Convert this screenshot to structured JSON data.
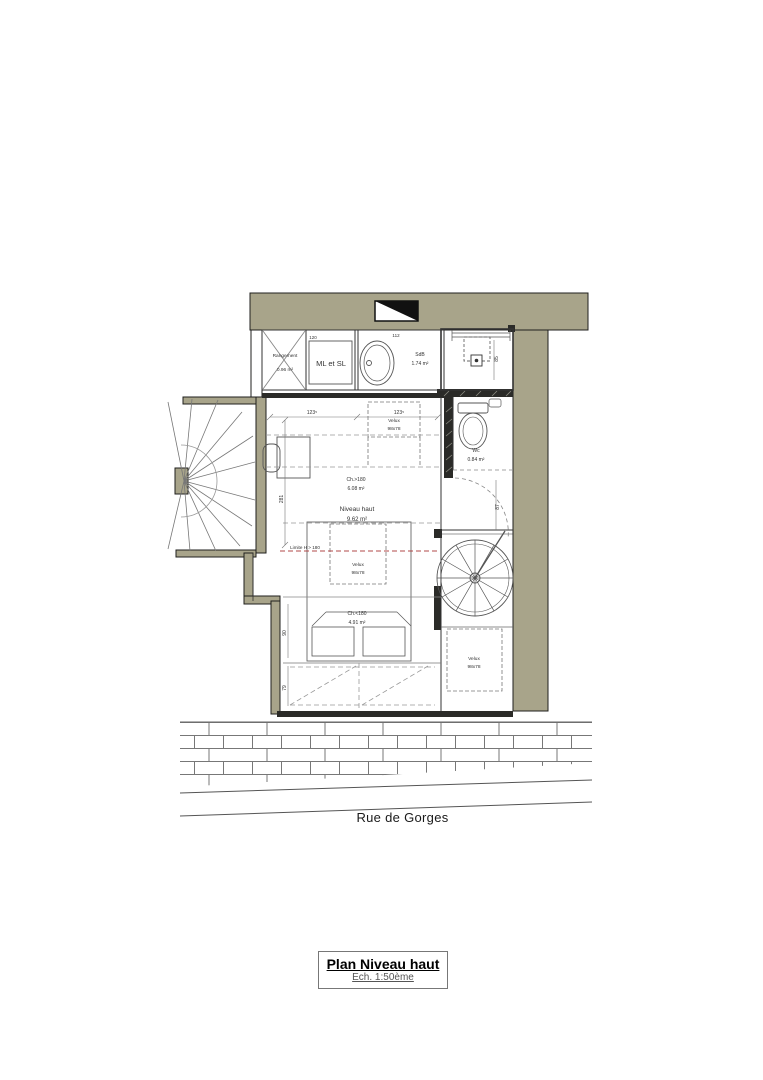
{
  "plan": {
    "title": "Plan Niveau haut",
    "scale": "Ech. 1:50ème",
    "street": "Rue de Gorges"
  },
  "labels": {
    "rangement": "Rangement",
    "rangement_area": "0.96 m²",
    "ml_sl": "ML et SL",
    "sdb": "SdB",
    "sdb_area": "1.74 m²",
    "wc": "Wc",
    "wc_area": "0.84 m²",
    "ch_sup": "Ch.>180",
    "ch_sup_area": "6.08 m²",
    "niveau": "Niveau haut",
    "niveau_area": "9.62 m²",
    "ch_inf": "Ch.<180",
    "ch_inf_area": "4.91 m²",
    "velux": "Velux",
    "velux_size": "98x78",
    "limite": "Limite H > 180"
  },
  "dims": {
    "w1": "123⁵",
    "w2": "123⁵",
    "h_main": "281",
    "h90": "90",
    "h79": "79",
    "h85": "85",
    "h87": "87",
    "d112": "112",
    "d120": "120"
  },
  "colors": {
    "wall": "#a8a48a",
    "wall_dark": "#2b2b28",
    "line": "#555555",
    "limit": "#b04848"
  }
}
